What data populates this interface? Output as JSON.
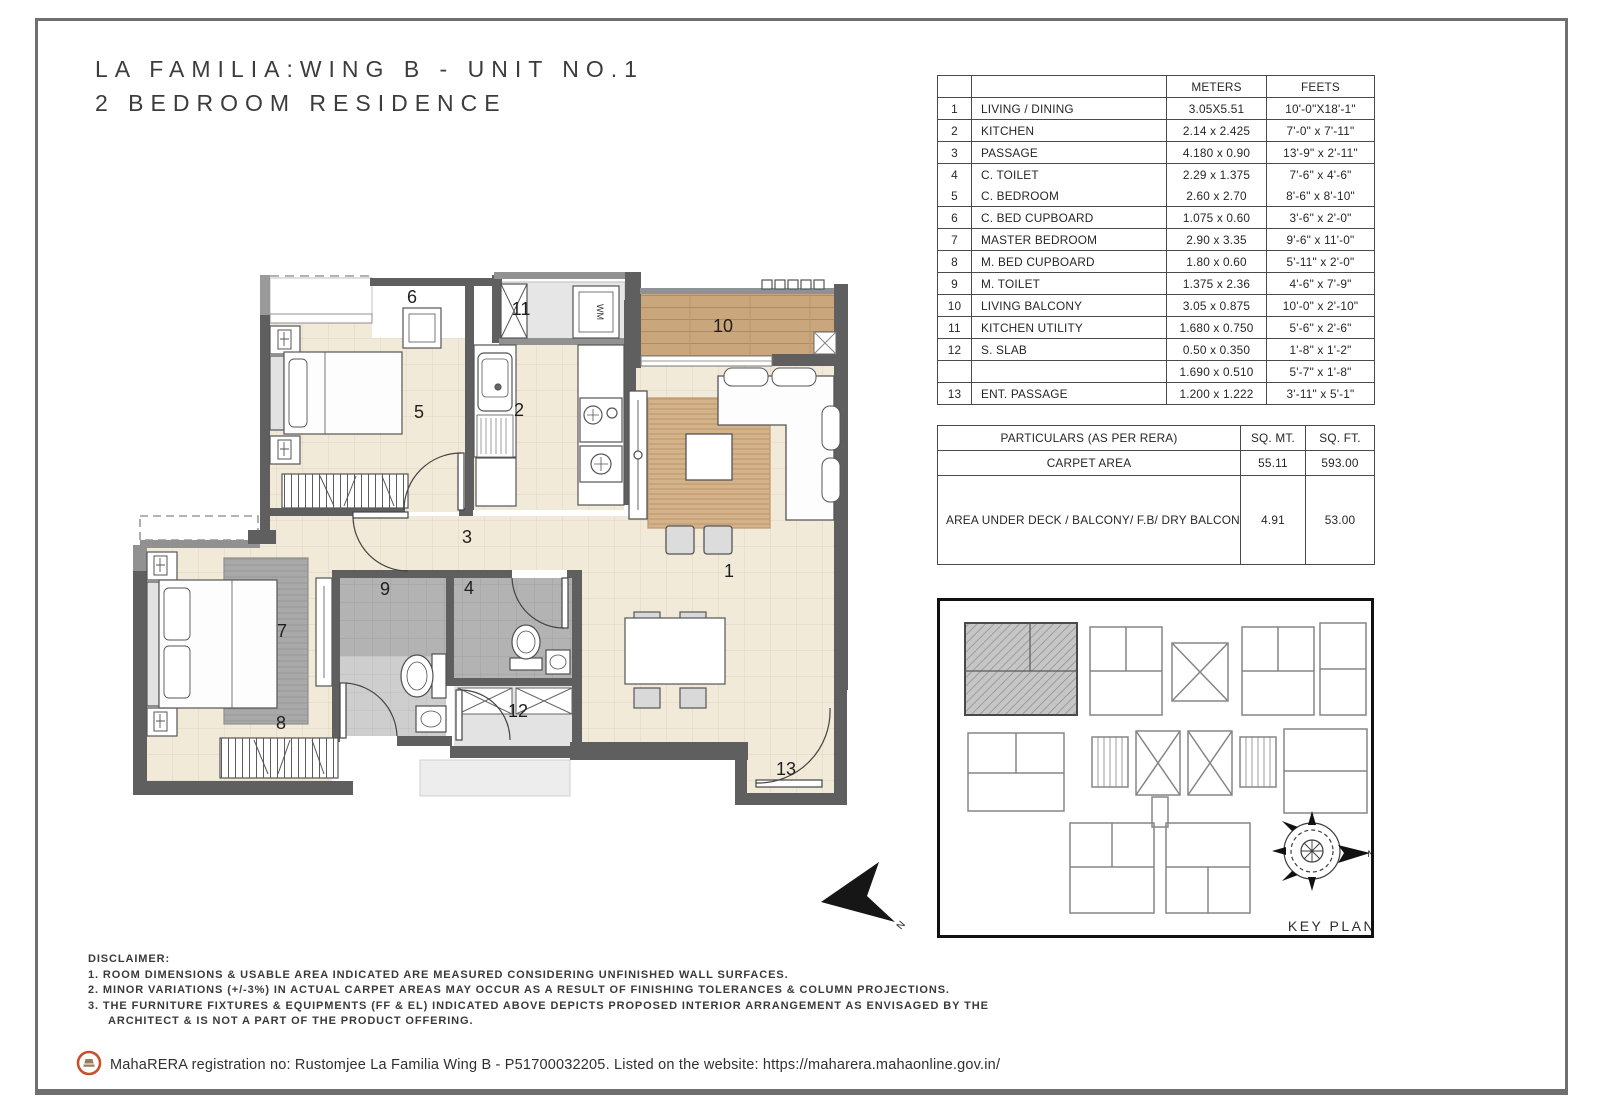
{
  "title": {
    "line1": "LA FAMILIA:WING B - UNIT NO.1",
    "line2": "2 BEDROOM RESIDENCE"
  },
  "dims_table": {
    "headers": {
      "meters": "METERS",
      "feets": "FEETS"
    },
    "rows": [
      {
        "no": "1",
        "name": "LIVING / DINING",
        "meters": "3.05X5.51",
        "feets": "10'-0\"X18'-1\""
      },
      {
        "no": "2",
        "name": "KITCHEN",
        "meters": "2.14 x 2.425",
        "feets": "7'-0\" x 7'-11\""
      },
      {
        "no": "3",
        "name": "PASSAGE",
        "meters": "4.180 x 0.90",
        "feets": "13'-9\" x 2'-11\""
      },
      {
        "no": "4",
        "name": "C. TOILET",
        "meters": "2.29 x 1.375",
        "feets": "7'-6\" x 4'-6\""
      },
      {
        "no": "5",
        "name": "C. BEDROOM",
        "meters": "2.60 x 2.70",
        "feets": "8'-6\" x 8'-10\"",
        "_cls": "nt"
      },
      {
        "no": "6",
        "name": "C. BED CUPBOARD",
        "meters": "1.075 x 0.60",
        "feets": "3'-6\" x 2'-0\""
      },
      {
        "no": "7",
        "name": "MASTER BEDROOM",
        "meters": "2.90 x 3.35",
        "feets": "9'-6\" x 11'-0\""
      },
      {
        "no": "8",
        "name": "M. BED CUPBOARD",
        "meters": "1.80 x 0.60",
        "feets": "5'-11\" x 2'-0\""
      },
      {
        "no": "9",
        "name": "M. TOILET",
        "meters": "1.375 x 2.36",
        "feets": "4'-6\" x 7'-9\""
      },
      {
        "no": "10",
        "name": "LIVING BALCONY",
        "meters": "3.05 x 0.875",
        "feets": "10'-0\" x 2'-10\""
      },
      {
        "no": "11",
        "name": "KITCHEN UTILITY",
        "meters": "1.680 x 0.750",
        "feets": "5'-6\" x 2'-6\""
      },
      {
        "no": "12",
        "name": "S. SLAB",
        "meters": "0.50 x 0.350",
        "feets": "1'-8\" x 1'-2\""
      },
      {
        "no": "",
        "name": "",
        "meters": "1.690 x 0.510",
        "feets": "5'-7\" x 1'-8\""
      },
      {
        "no": "13",
        "name": "ENT. PASSAGE",
        "meters": "1.200 x 1.222",
        "feets": "3'-11\" x 5'-1\""
      }
    ]
  },
  "rera_table": {
    "header": {
      "particulars": "PARTICULARS (AS PER RERA)",
      "sqmt": "SQ. MT.",
      "sqft": "SQ. FT."
    },
    "carpet": {
      "label": "CARPET AREA",
      "sqmt": "55.11",
      "sqft": "593.00"
    },
    "deck": {
      "label": "AREA UNDER DECK / BALCONY/ F.B/ DRY BALCONY / ENCL. BALCONY / SERVICE SLAB FOR EXCLUSIVE USE OF THE ALLOTTEE",
      "sqmt": "4.91",
      "sqft": "53.00"
    }
  },
  "floorplan": {
    "labels": {
      "r1": "1",
      "r2": "2",
      "r3": "3",
      "r4": "4",
      "r5": "5",
      "r6": "6",
      "r7": "7",
      "r8": "8",
      "r9": "9",
      "r10": "10",
      "r11": "11",
      "r12": "12",
      "r13": "13"
    },
    "wm": "WM",
    "north": "N"
  },
  "keyplan": {
    "label": "KEY PLAN",
    "north": "N"
  },
  "disclaimer": {
    "heading": "DISCLAIMER:",
    "lines": [
      "1. ROOM DIMENSIONS & USABLE AREA INDICATED ARE MEASURED CONSIDERING UNFINISHED WALL SURFACES.",
      "2. MINOR VARIATIONS (+/-3%) IN ACTUAL CARPET AREAS MAY OCCUR AS A RESULT OF FINISHING TOLERANCES & COLUMN PROJECTIONS.",
      "3. THE FURNITURE FIXTURES & EQUIPMENTS (FF & EL) INDICATED ABOVE DEPICTS PROPOSED INTERIOR ARRANGEMENT AS ENVISAGED BY THE",
      "ARCHITECT & IS NOT A PART OF THE PRODUCT OFFERING."
    ]
  },
  "footer": {
    "text": "MahaRERA registration no: Rustomjee La Familia Wing B - P51700032205. Listed on the website: https://maharera.mahaonline.gov.in/"
  },
  "colors": {
    "accent_orange": "#c8502a",
    "wall_dark": "#5f5f5f",
    "floor_cream": "#f1ead9",
    "wood": "#c9a67c"
  }
}
